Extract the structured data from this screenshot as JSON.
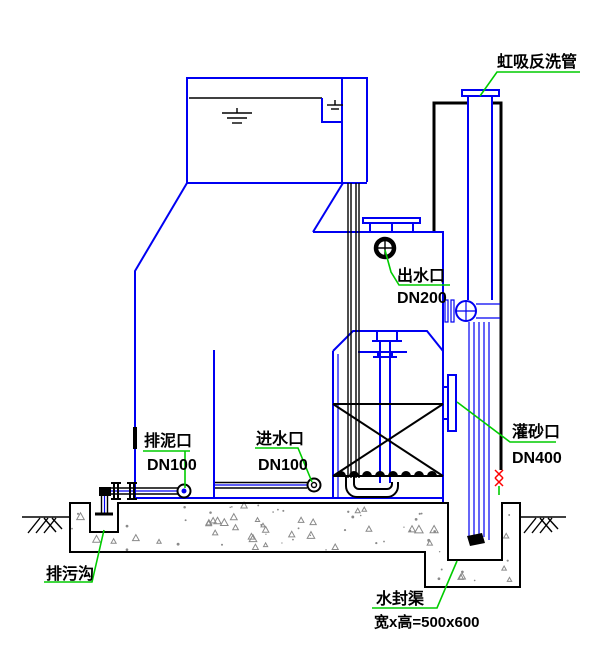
{
  "drawing": {
    "kind": "siphon-filter-tank-section",
    "colors": {
      "outline_blue": "#0000f2",
      "ink_black": "#000000",
      "leader_green": "#00cc00",
      "alarm_red": "#ff0000",
      "concrete_gray": "#8a8a8a"
    },
    "annotations": {
      "siphon_backwash_pipe": {
        "label": "虹吸反洗管"
      },
      "outlet_port": {
        "label": "出水口",
        "size": "DN200"
      },
      "sludge_drain_port": {
        "label": "排泥口",
        "size": "DN100"
      },
      "inlet_port": {
        "label": "进水口",
        "size": "DN100"
      },
      "sand_fill_port": {
        "label": "灌砂口",
        "size": "DN400"
      },
      "sewage_ditch": {
        "label": "排污沟"
      },
      "water_seal_channel": {
        "label": "水封渠",
        "dimension": "宽x高=500x600"
      }
    }
  }
}
